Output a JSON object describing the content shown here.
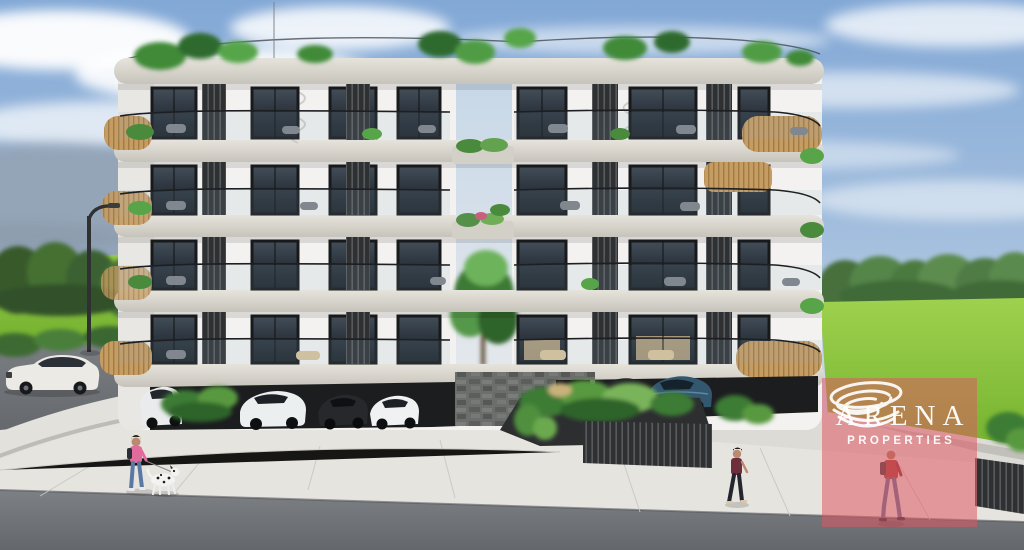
{
  "meta": {
    "type": "3d-architectural-rendering",
    "subject": "modern white residential apartment building with carport parking, street scene, lawns and trees"
  },
  "watermark": {
    "brand": "ARENA",
    "subtitle": "PROPERTIES",
    "icon": "swirl-spiral-icon",
    "overlay_color": "#DE5863",
    "text_color": "#FFFFFF"
  },
  "scene": {
    "sky": {
      "top_color": "#85AAD7",
      "horizon_color": "#E3EAF1",
      "clouds": "scattered white cumulus and wisps"
    },
    "building": {
      "stories_above_parking": 4,
      "wall_color": "#F3F2EF",
      "slab_color": "#DBD8D1",
      "window_frame_color": "#17191B",
      "features": [
        "curved concrete balcony slabs",
        "dark vertical louver screens",
        "timber slat balcony fronts",
        "glass balustrades",
        "roof garden planting",
        "central courtyard void with tree",
        "spiral staircases",
        "stone-clad entrance wall"
      ]
    },
    "ground": {
      "left_grass_color": "#7FBC33",
      "right_grass_color": "#86C23C",
      "road_color": "#6F7276",
      "sidewalk_color": "#E6E4DF"
    },
    "vehicles": [
      "white luxury sedan on street",
      "white suv in carport",
      "white sedan in carport",
      "black car in carport",
      "white coupe in carport",
      "dark sedan in carport",
      "blue sedan in carport"
    ],
    "people": [
      "woman in pink jacket walking dalmatian dog",
      "woman in dark top walking",
      "man in red jacket with backpack walking"
    ]
  }
}
